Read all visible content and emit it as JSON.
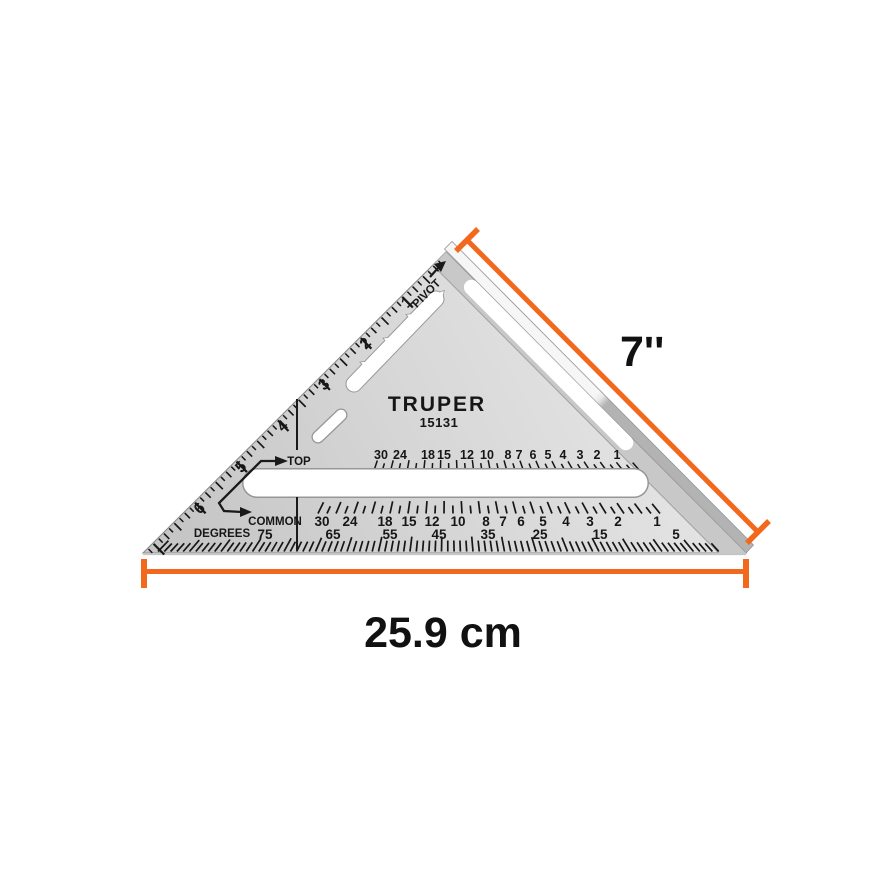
{
  "product": {
    "brand": "TRUPER",
    "model": "15131"
  },
  "labels": {
    "pivot": "PIVOT",
    "top": "TOP",
    "common": "COMMON",
    "degrees": "DEGREES"
  },
  "dimensions": {
    "hypotenuse_label": "7''",
    "base_label": "25.9 cm"
  },
  "scales": {
    "inch_edge": [
      "1",
      "2",
      "3",
      "4",
      "5",
      "6"
    ],
    "rafter_top": [
      "30",
      "24",
      "18",
      "15",
      "12",
      "10",
      "8",
      "7",
      "6",
      "5",
      "4",
      "3",
      "2",
      "1"
    ],
    "rafter_bottom": [
      "30",
      "24",
      "18",
      "15",
      "12",
      "10",
      "8",
      "7",
      "6",
      "5",
      "4",
      "3",
      "2",
      "1"
    ],
    "degrees": [
      "75",
      "65",
      "55",
      "45",
      "35",
      "25",
      "15",
      "5"
    ]
  },
  "icons": {
    "pivot_arrow": "arrow pointing to pivot corner",
    "top_common_arrow": "bent double arrow pointing to TOP and COMMON scales"
  },
  "colors": {
    "accent_orange": "#f2681c",
    "marking_black": "#161616",
    "metal_light": "#e6e6e6",
    "metal_dark": "#c9c9c9"
  }
}
